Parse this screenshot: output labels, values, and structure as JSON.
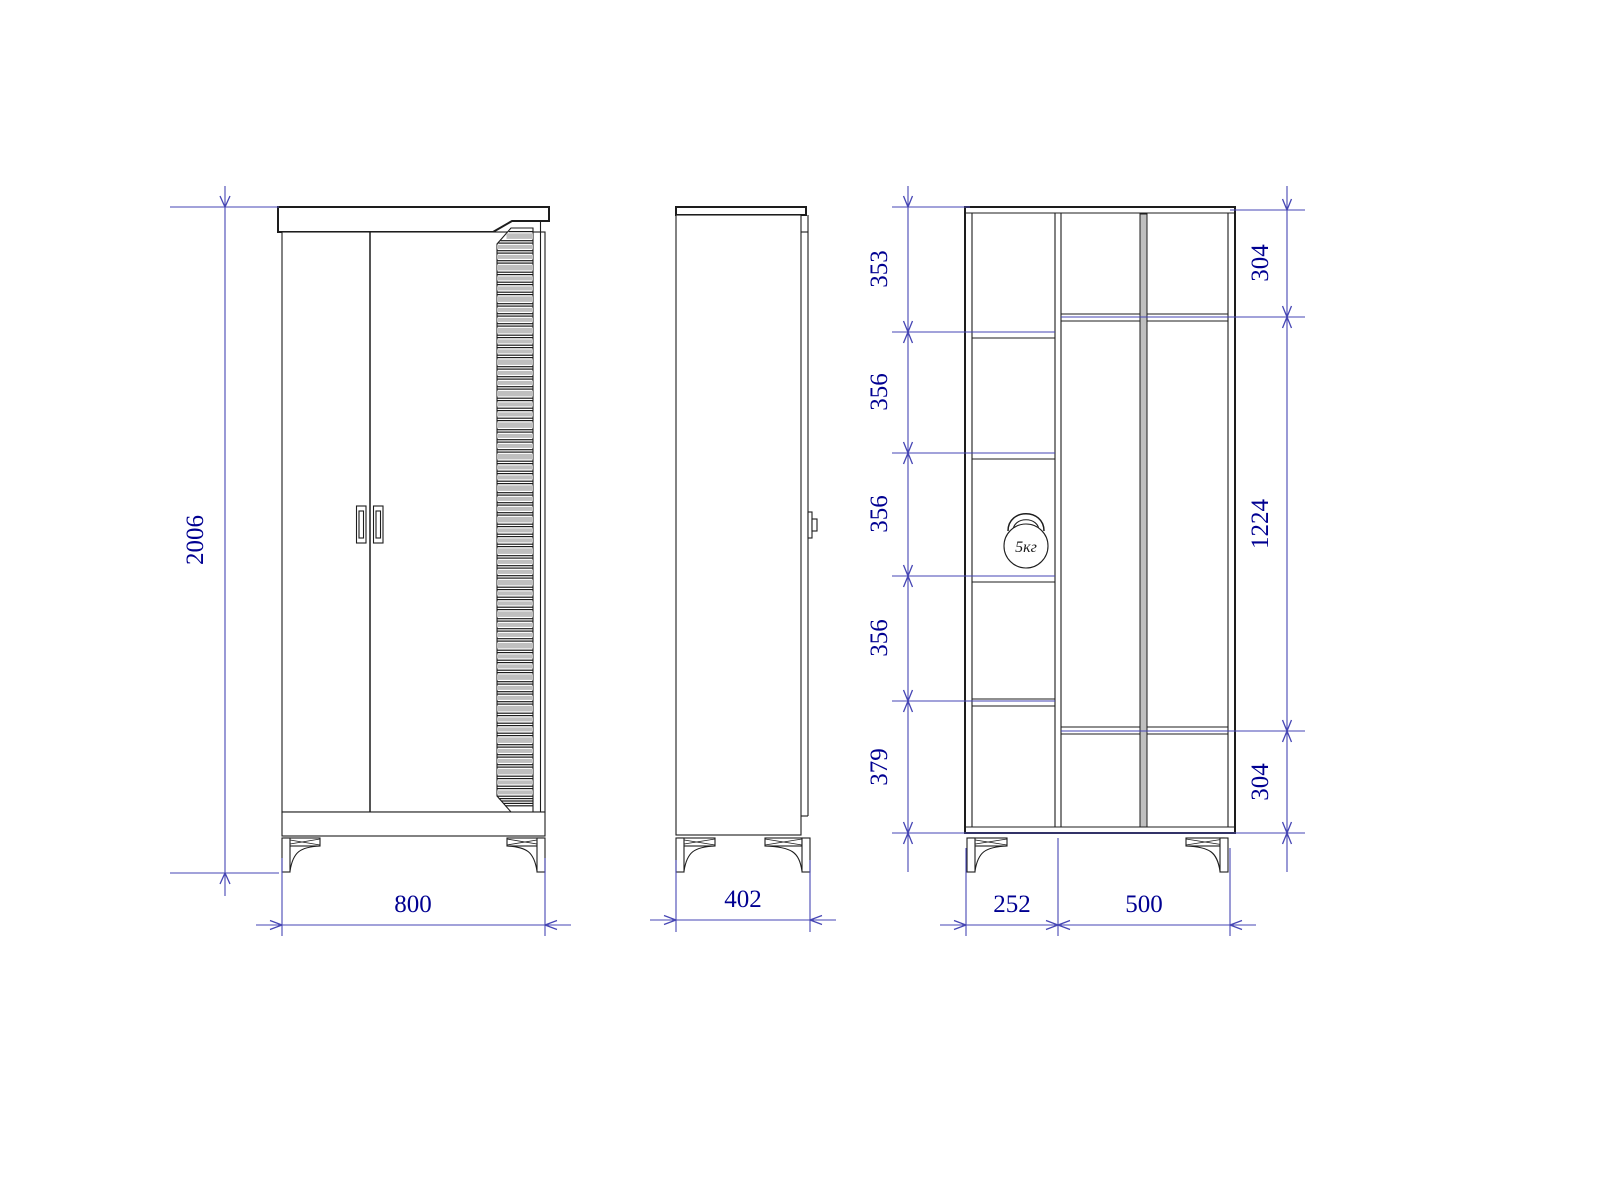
{
  "drawing": {
    "type": "furniture-orthographic-views",
    "subject": "two-door wardrobe with decorative slatted side panel, shown as front view, side view and interior section",
    "background": "#ffffff",
    "colors": {
      "drawing_lines": "#1d1d1d",
      "dimension_lines": "#4646b4",
      "dimension_text": "#000091",
      "panel_fill": "#bfbfbf"
    },
    "icons": {
      "load_capacity": "kettlebell-icon"
    },
    "views": {
      "front": {
        "height": "2006",
        "width": "800"
      },
      "side": {
        "depth": "402"
      },
      "interior": {
        "left_shelf_heights": [
          "353",
          "356",
          "356",
          "356",
          "379"
        ],
        "right_section_heights": [
          "304",
          "1224",
          "304"
        ],
        "section_widths": [
          "252",
          "500"
        ],
        "load_capacity": "5кг"
      }
    }
  }
}
